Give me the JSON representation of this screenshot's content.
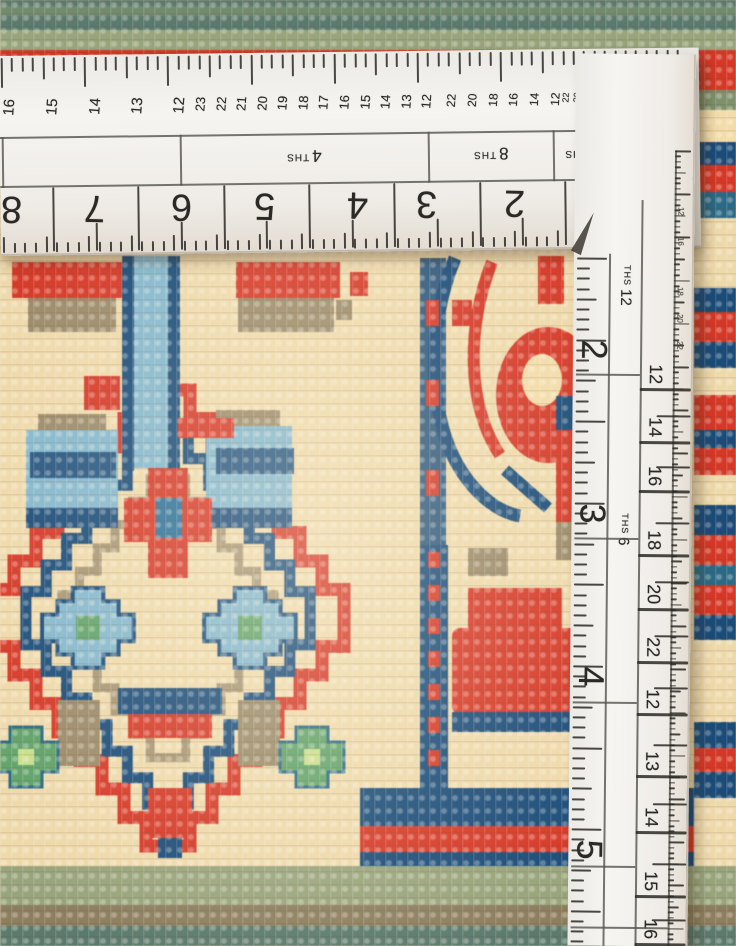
{
  "colors": {
    "ruler_ink": "#26241f",
    "ruler_body": "#f3f0ec",
    "cream": "#eed9ab",
    "cream_light": "#f7ead0",
    "red": "#cf3b2b",
    "red_deep": "#b73327",
    "navy": "#1f4d78",
    "blue_mid": "#2f6f96",
    "light_blue": "#85b5ca",
    "teal": "#2f6a85",
    "green": "#63a06c",
    "green_light": "#c9dc8e",
    "sage": "#98a37d",
    "olive": "#7e906e",
    "dark_teal": "#5d7a6e",
    "taupe": "#9a8a6b",
    "brown": "#8b7e61"
  },
  "horizontal_ruler": {
    "corner_value": "24",
    "unit_cells": [
      {
        "value": "",
        "unit": "",
        "x0": 2,
        "x1": 180
      },
      {
        "value": "4",
        "unit": "THS",
        "x0": 180,
        "x1": 428
      },
      {
        "value": "8",
        "unit": "THS",
        "x0": 428,
        "x1": 553
      },
      {
        "value": "16",
        "unit": "THS",
        "x0": 553,
        "x1": 620
      },
      {
        "value": "32",
        "unit": "",
        "x0": 620,
        "x1": 657
      }
    ],
    "inch_numbers": [
      {
        "v": "8",
        "x": 10
      },
      {
        "v": "7",
        "x": 93
      },
      {
        "v": "6",
        "x": 180
      },
      {
        "v": "5",
        "x": 263
      },
      {
        "v": "4",
        "x": 356
      },
      {
        "v": "3",
        "x": 425
      },
      {
        "v": "2",
        "x": 513
      }
    ],
    "edge_scales": [
      {
        "size": 15,
        "numbers": [
          {
            "v": "16",
            "x": 10
          },
          {
            "v": "15",
            "x": 53
          },
          {
            "v": "14",
            "x": 96
          },
          {
            "v": "13",
            "x": 138
          },
          {
            "v": "12",
            "x": 180
          }
        ]
      },
      {
        "size": 13,
        "numbers": [
          {
            "v": "23",
            "x": 201
          },
          {
            "v": "22",
            "x": 222
          },
          {
            "v": "21",
            "x": 242
          },
          {
            "v": "20",
            "x": 263
          },
          {
            "v": "19",
            "x": 283
          },
          {
            "v": "18",
            "x": 304
          },
          {
            "v": "17",
            "x": 324
          },
          {
            "v": "16",
            "x": 345
          },
          {
            "v": "15",
            "x": 366
          },
          {
            "v": "14",
            "x": 386
          },
          {
            "v": "13",
            "x": 407
          },
          {
            "v": "12",
            "x": 427
          }
        ]
      },
      {
        "size": 12,
        "numbers": [
          {
            "v": "22",
            "x": 452
          },
          {
            "v": "20",
            "x": 473
          },
          {
            "v": "18",
            "x": 494
          },
          {
            "v": "16",
            "x": 514
          },
          {
            "v": "14",
            "x": 535
          },
          {
            "v": "12",
            "x": 556
          }
        ]
      },
      {
        "size": 9,
        "numbers": [
          {
            "v": "22",
            "x": 567
          },
          {
            "v": "20",
            "x": 578
          },
          {
            "v": "18",
            "x": 589
          },
          {
            "v": "16",
            "x": 600
          },
          {
            "v": "14",
            "x": 610
          },
          {
            "v": "12",
            "x": 621
          }
        ]
      },
      {
        "size": 8,
        "numbers": [
          {
            "v": "20",
            "x": 631
          },
          {
            "v": "16",
            "x": 641
          },
          {
            "v": "12",
            "x": 651
          }
        ]
      }
    ]
  },
  "vertical_ruler": {
    "unit_cells": [
      {
        "value": "12",
        "unit": "THS",
        "y": 288
      },
      {
        "value": "6",
        "unit": "THS",
        "y": 532
      }
    ],
    "inch_numbers": [
      {
        "v": "2",
        "y": 350
      },
      {
        "v": "3",
        "y": 514
      },
      {
        "v": "4",
        "y": 677
      },
      {
        "v": "5",
        "y": 850
      }
    ],
    "side_numbers": [
      {
        "v": "12",
        "y": 374
      },
      {
        "v": "14",
        "y": 427
      },
      {
        "v": "16",
        "y": 476
      },
      {
        "v": "18",
        "y": 540
      },
      {
        "v": "20",
        "y": 594
      },
      {
        "v": "22",
        "y": 647
      },
      {
        "v": "12",
        "y": 699
      },
      {
        "v": "13",
        "y": 761
      },
      {
        "v": "14",
        "y": 817
      },
      {
        "v": "15",
        "y": 881
      },
      {
        "v": "16",
        "y": 929
      }
    ],
    "edge_numbers": [
      {
        "v": "12",
        "y": 212
      },
      {
        "v": "16",
        "y": 242
      },
      {
        "v": "18",
        "y": 292
      },
      {
        "v": "20",
        "y": 319
      },
      {
        "v": "22",
        "y": 346
      }
    ]
  }
}
